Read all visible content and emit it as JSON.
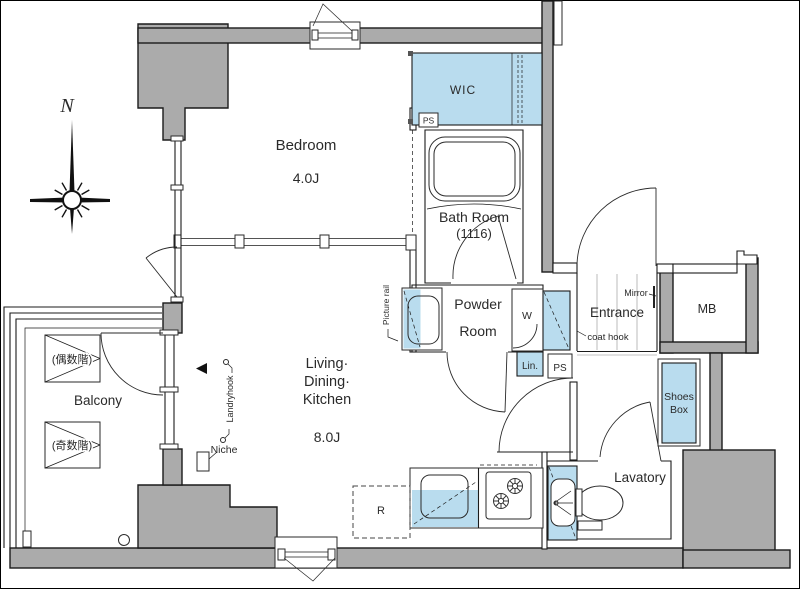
{
  "plan": {
    "compass": {
      "north": "N"
    },
    "rooms": {
      "bedroom": {
        "name": "Bedroom",
        "size": "4.0J"
      },
      "wic": {
        "name": "WIC"
      },
      "bath": {
        "name": "Bath Room",
        "size": "(1116)"
      },
      "powder": {
        "name_line1": "Powder",
        "name_line2": "Room"
      },
      "ldk": {
        "name_line1": "Living·",
        "name_line2": "Dining·",
        "name_line3": "Kitchen",
        "size": "8.0J"
      },
      "entrance": {
        "name": "Entrance"
      },
      "lavatory": {
        "name": "Lavatory"
      },
      "balcony": {
        "name": "Balcony",
        "even_floor_note": "(偶数階)",
        "odd_floor_note": "(奇数階)"
      }
    },
    "fixtures": {
      "mb": "MB",
      "shoes_line1": "Shoes",
      "shoes_line2": "Box",
      "w": "W",
      "lin": "Lin.",
      "ps_upper": "PS",
      "ps_lower": "PS",
      "r": "R",
      "mirror": "Mirror",
      "coat_hook": "coat hook",
      "niche": "Niche",
      "laundry_hook": "Landryhook",
      "picture_rail": "Picture rail"
    },
    "colors": {
      "wall": "#ababab",
      "fixture_blue": "#b9dcee",
      "line": "#1b1b1b"
    }
  }
}
